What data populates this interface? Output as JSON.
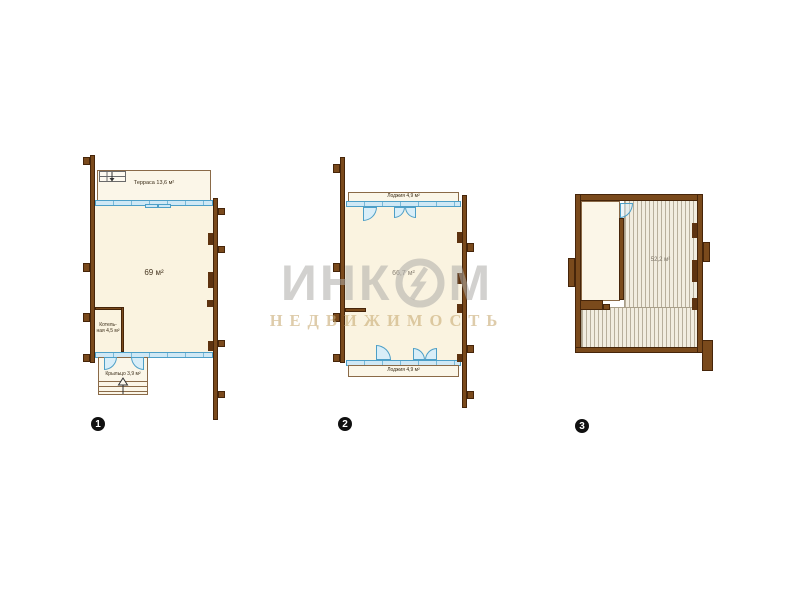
{
  "watermark": {
    "brand_prefix": "ИНК",
    "brand_suffix": "М",
    "logo_icon": "incom-ring-logo",
    "subtitle": "НЕДВИЖИМОСТЬ"
  },
  "colors": {
    "wall_brown": "#7a4a1c",
    "room_cream": "#faf3e0",
    "glazing_blue": "#4d9fc7",
    "hatch_line": "#b8af9c",
    "watermark_gray": "#adaba7",
    "watermark_tan": "#c9ac78"
  },
  "plans": [
    {
      "badge": "1",
      "labels": {
        "terrace": "Терраса 13,6 м²",
        "main_area": "69 м²",
        "boiler_line1": "Котель-",
        "boiler_line2": "ная 4,5 м²",
        "porch": "Крыльцо 3,9 м²"
      }
    },
    {
      "badge": "2",
      "labels": {
        "loggia_top": "Лоджия 4,9 м²",
        "main_area": "66,7 м²",
        "loggia_bottom": "Лоджия 4,9 м²"
      }
    },
    {
      "badge": "3",
      "labels": {
        "main_area": "52,2 м²"
      }
    }
  ]
}
